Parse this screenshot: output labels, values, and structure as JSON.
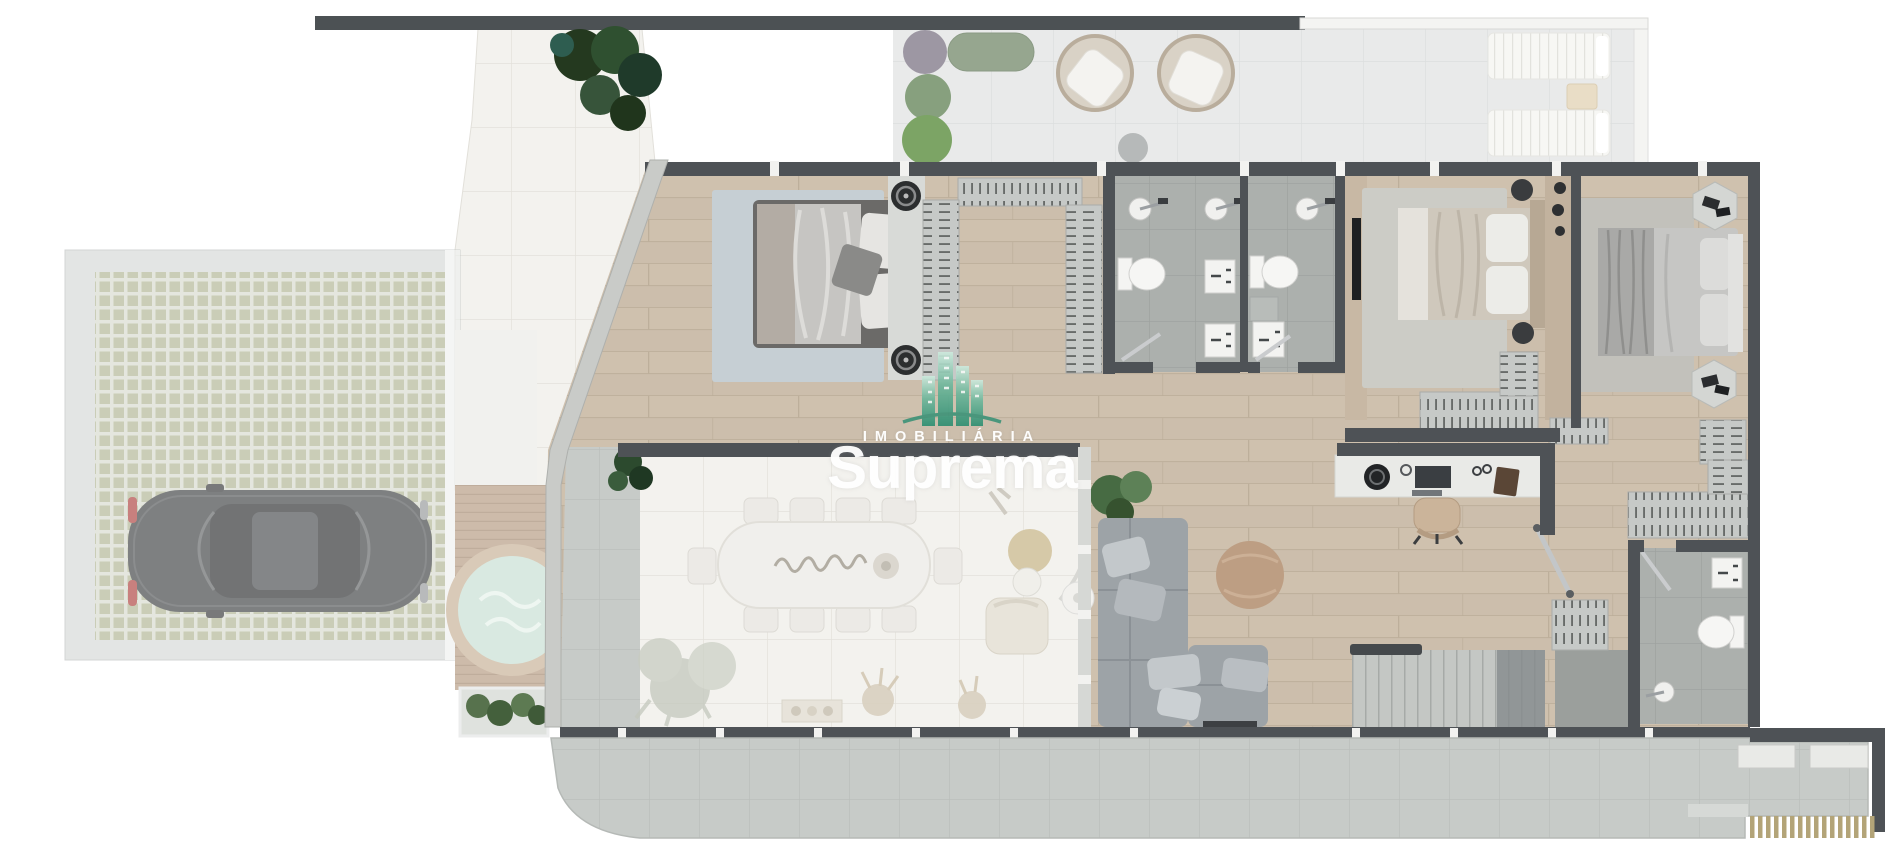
{
  "watermark": {
    "brand_top": "IMOBILIÁRIA",
    "brand_main": "Suprema",
    "logo_icon": "buildings-logo-icon",
    "text_color": "#ffffff",
    "logo_teal": "#48a187"
  },
  "palette": {
    "wall_dark": "#4e5256",
    "wall_light": "#c9cbc8",
    "wood_floor": "#cfc1ae",
    "white_tile": "#f3f2ee",
    "gray_tile": "#acb0ad",
    "terrace_tile": "#e9eaea",
    "apron_tile": "#c7cbc8",
    "paver_green": "#aab08c",
    "sofa_gray": "#9da3a7",
    "pouf_tan": "#bd9e83",
    "spa_water": "#d9e9e1",
    "deck_wood": "#cdbbaa",
    "car_black": "#303335",
    "plant_green": "#4e6a47",
    "closet_gray": "#c6c9c7",
    "bed_duvet": "#c6c5c2",
    "rug_blue_gray": "#c6cfd4"
  },
  "scene": {
    "type": "floor-plan-render",
    "view": "top-down",
    "rooms": [
      {
        "name": "garage",
        "furniture": [
          "black-car",
          "green-grid-pavers"
        ]
      },
      {
        "name": "entry-walkway",
        "furniture": [
          "plants"
        ]
      },
      {
        "name": "spa-deck",
        "furniture": [
          "round-spa",
          "planter"
        ]
      },
      {
        "name": "terrace",
        "furniture": [
          "egg-chair",
          "egg-chair",
          "sun-lounger",
          "sun-lounger",
          "side-table",
          "stool",
          "bushes"
        ]
      },
      {
        "name": "master-bedroom",
        "furniture": [
          "double-bed",
          "rug",
          "speaker",
          "speaker",
          "walk-in-closet"
        ]
      },
      {
        "name": "bathroom-1",
        "furniture": [
          "shower",
          "shower",
          "toilet",
          "vanity",
          "vanity"
        ]
      },
      {
        "name": "bathroom-2",
        "furniture": [
          "shower",
          "toilet",
          "shelf",
          "vanity"
        ]
      },
      {
        "name": "bedroom-2",
        "furniture": [
          "double-bed",
          "rug",
          "tv-panel",
          "wardrobe"
        ]
      },
      {
        "name": "bedroom-3",
        "furniture": [
          "double-bed",
          "rug",
          "hex-side-table",
          "hex-side-table",
          "dresser"
        ]
      },
      {
        "name": "home-office",
        "furniture": [
          "desk",
          "office-chair",
          "turntable",
          "laptop",
          "book",
          "glasses"
        ]
      },
      {
        "name": "dining-room",
        "furniture": [
          "marble-table",
          "dining-chairs",
          "lounge-chair",
          "coffee-table",
          "arc-lamp",
          "planter-tray",
          "pampas",
          "palm"
        ]
      },
      {
        "name": "living-room",
        "furniture": [
          "sectional-sofa",
          "round-pouf",
          "palm-plant",
          "tv-console"
        ]
      },
      {
        "name": "staircase",
        "furniture": [
          "steps",
          "handrail"
        ]
      },
      {
        "name": "bathroom-3",
        "furniture": [
          "toilet",
          "vanity",
          "shower"
        ]
      },
      {
        "name": "rear-porch",
        "furniture": [
          "planter-box",
          "planter-box",
          "slat-fence"
        ]
      }
    ]
  }
}
